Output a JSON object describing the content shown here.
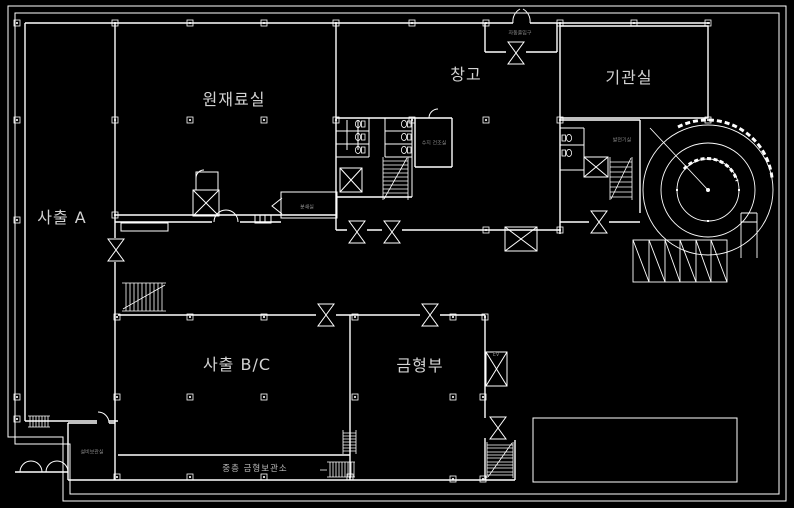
{
  "drawing": {
    "type": "cad-floor-plan",
    "colors": {
      "background": "#000000",
      "line": "#ffffff",
      "label": "#d2d2d2",
      "small_label": "#9a9a9a"
    }
  },
  "rooms": [
    {
      "id": "sachul-a",
      "label": "사출 A"
    },
    {
      "id": "wonjaeryosil",
      "label": "원재료실"
    },
    {
      "id": "changgo",
      "label": "창고"
    },
    {
      "id": "gigwansil",
      "label": "기관실"
    },
    {
      "id": "sachul-bc",
      "label": "사출 B/C"
    },
    {
      "id": "geumhyeongbu",
      "label": "금형부"
    }
  ],
  "annotations": [
    {
      "id": "vestibule",
      "text": "자동출입구"
    },
    {
      "id": "resin-room",
      "text": "수지 건조실"
    },
    {
      "id": "grinding-room",
      "text": "분쇄실"
    },
    {
      "id": "generator-room",
      "text": "발전기실"
    },
    {
      "id": "equipment-store",
      "text": "설비보관실"
    },
    {
      "id": "mezzanine-store",
      "text": "중층 금형보관소"
    },
    {
      "id": "elevator",
      "text": "EV"
    }
  ]
}
